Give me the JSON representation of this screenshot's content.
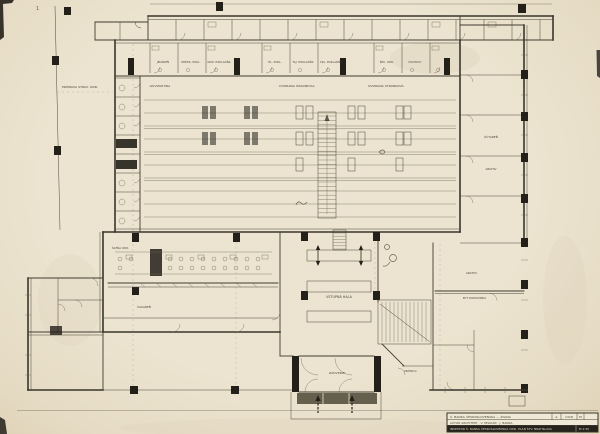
{
  "colors": {
    "paper": "#ece4d0",
    "ink": "#3e3a31",
    "wall_dark": "#23201a"
  },
  "plan": {
    "site_label": "PRÍPRAVA STRAV. ODD.",
    "office_labels": [
      "JEDÁREŇ",
      "PREDS. POKL.",
      "ODD. POKLADŇA",
      "HL. POKL.",
      "TAJ. POKLADŇA",
      "VKL. POKLADŇA",
      "ŠEK. ODD.",
      "ÚSCHOVY"
    ],
    "hall_labels": {
      "left": "LIKVIDATÚRA",
      "center": "DVORANA ÚRADNÍCKA",
      "right": "DVORANA STRÁNKOVÁ"
    },
    "right_wing": {
      "room1": "ÚČTÁREŇ",
      "room2": "ARCHÍV"
    },
    "lower_left": {
      "room1": "ŠATŇA ODD.",
      "room2": "ČAKÁREŇ"
    },
    "lower_center": {
      "hall": "VSTUPNÁ HALA",
      "entry": "ZÁDVERIE",
      "porter": "VRÁTNICA"
    },
    "lower_right": {
      "room1": "ARCHÍV",
      "room2": "BYT DOMOVNÍKA"
    },
    "sheet_mark": "1"
  },
  "title_block": {
    "row1": "Š. BANKA ČESKOSLOVENSKÁ — ŽILINA",
    "cells": {
      "c1": "A",
      "c2": "1318",
      "c3": "M"
    },
    "row2": "AUTOR ARCHITEKT · V. PELIKÁN · J. BANKA",
    "row3": "INVESTOR Š. BANKA ČESKOSLOVENSKÁ ODD. PLÁN ŠTV. BRATISLAVA",
    "scale": "M 1:50"
  }
}
